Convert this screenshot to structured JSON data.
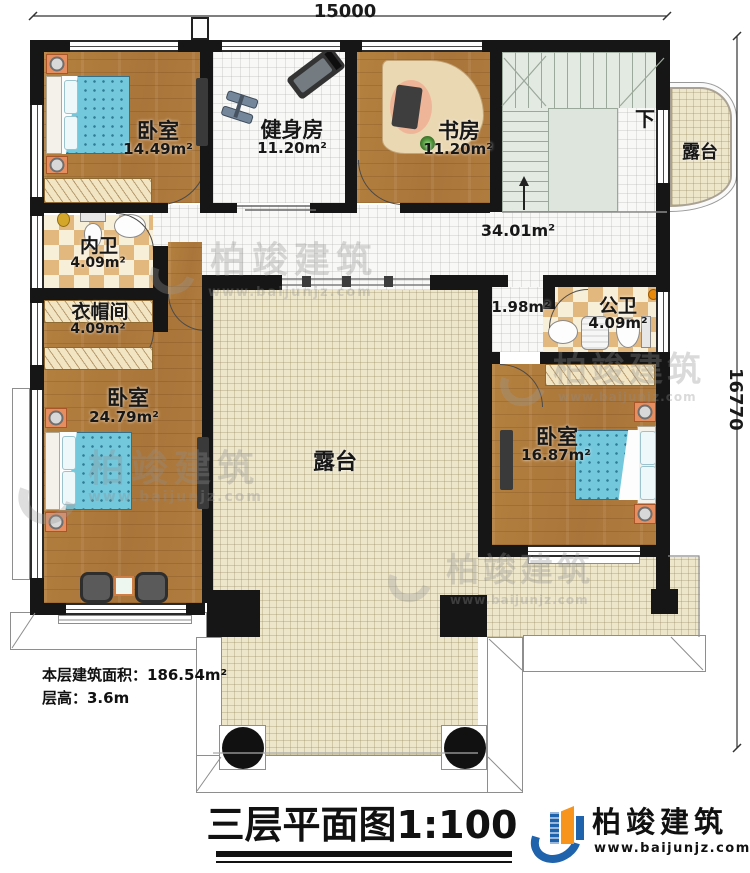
{
  "dimensions": {
    "width_label": "15000",
    "height_label": "16770"
  },
  "rooms": {
    "bedroom_top_left": {
      "name": "卧室",
      "area": "14.49m²"
    },
    "gym": {
      "name": "健身房",
      "area": "11.20m²"
    },
    "study": {
      "name": "书房",
      "area": "11.20m²"
    },
    "terrace_right": {
      "name": "露台"
    },
    "hallway": {
      "area": "34.01m²"
    },
    "inner_bathroom": {
      "name": "内卫",
      "area": "4.09m²"
    },
    "cloakroom": {
      "name": "衣帽间",
      "area": "4.09m²"
    },
    "bedroom_left": {
      "name": "卧室",
      "area": "24.79m²"
    },
    "small_passage": {
      "area": "1.98m²"
    },
    "public_bathroom": {
      "name": "公卫",
      "area": "4.09m²"
    },
    "bedroom_right": {
      "name": "卧室",
      "area": "16.87m²"
    },
    "terrace_center": {
      "name": "露台"
    }
  },
  "stairs": {
    "down_label": "下"
  },
  "notes": {
    "floor_area": "本层建筑面积：186.54m²",
    "floor_height": "层高：3.6m"
  },
  "title": "三层平面图1:100",
  "brand": {
    "name": "柏竣建筑",
    "url": "www.baijunjz.com"
  },
  "watermark": {
    "name": "柏竣建筑",
    "url": "www.baijunjz.com"
  },
  "colors": {
    "wall": "#161616",
    "wood": "#b07c3c",
    "tile": "#f7f7f5",
    "terrace_tile": "#ede6cb",
    "brand_blue": "#1f63ad",
    "brand_orange": "#f7941d"
  }
}
